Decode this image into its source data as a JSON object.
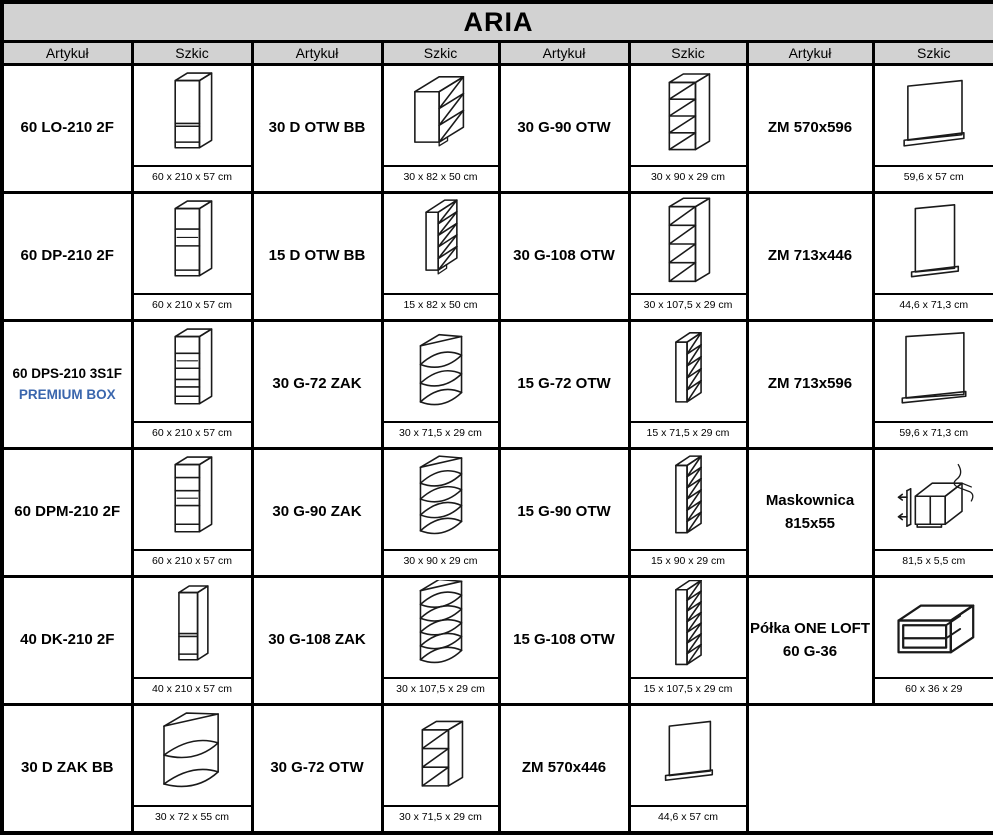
{
  "title": "ARIA",
  "column_headers": [
    "Artykuł",
    "Szkic",
    "Artykuł",
    "Szkic",
    "Artykuł",
    "Szkic",
    "Artykuł",
    "Szkic"
  ],
  "colors": {
    "header_bg": "#d2d2d2",
    "accent_blue": "#3a66ad",
    "line_color": "#1a1a1a"
  },
  "rows": [
    [
      {
        "article": "60 LO-210 2F",
        "sketch": "tall-cabinet-2f",
        "dims": "60 x 210 x 57 cm"
      },
      {
        "article": "30 D OTW BB",
        "sketch": "base-open-shelf",
        "dims": "30 x 82 x 50 cm"
      },
      {
        "article": "30 G-90 OTW",
        "sketch": "wall-open-4",
        "dims": "30 x 90 x 29 cm"
      },
      {
        "article": "ZM 570x596",
        "sketch": "panel",
        "dims": "59,6 x 57 cm"
      }
    ],
    [
      {
        "article": "60 DP-210 2F",
        "sketch": "tall-cabinet-niche",
        "dims": "60 x 210 x 57 cm"
      },
      {
        "article": "15 D OTW BB",
        "sketch": "narrow-base-open",
        "dims": "15 x 82 x 50 cm"
      },
      {
        "article": "30 G-108 OTW",
        "sketch": "wall-open-4-tall",
        "dims": "30 x 107,5 x 29 cm"
      },
      {
        "article": "ZM 713x446",
        "sketch": "panel-tall",
        "dims": "44,6 x 71,3 cm"
      }
    ],
    [
      {
        "article": "60 DPS-210 3S1F",
        "article_line2": "PREMIUM BOX",
        "accent": true,
        "small": true,
        "sketch": "tall-cabinet-drawers",
        "dims": "60 x 210 x 57 cm"
      },
      {
        "article": "30 G-72 ZAK",
        "sketch": "corner-shelf-3",
        "dims": "30 x 71,5 x 29 cm"
      },
      {
        "article": "15 G-72 OTW",
        "sketch": "narrow-wall-open-5",
        "dims": "15 x 71,5 x 29 cm"
      },
      {
        "article": "ZM 713x596",
        "sketch": "panel-wide",
        "dims": "59,6 x 71,3 cm"
      }
    ],
    [
      {
        "article": "60 DPM-210 2F",
        "sketch": "tall-cabinet-niche-2",
        "dims": "60 x 210 x 57 cm"
      },
      {
        "article": "30 G-90 ZAK",
        "sketch": "corner-shelf-4",
        "dims": "30 x 90 x 29 cm"
      },
      {
        "article": "15 G-90 OTW",
        "sketch": "narrow-wall-open-6",
        "dims": "15 x 90 x 29 cm"
      },
      {
        "article": "Maskownica",
        "article_line2": "815x55",
        "sketch": "masking-strip-cabinet",
        "dims": "81,5 x 5,5 cm"
      }
    ],
    [
      {
        "article": "40 DK-210 2F",
        "sketch": "tall-cabinet-2f-narrow",
        "dims": "40 x 210 x 57 cm"
      },
      {
        "article": "30 G-108 ZAK",
        "sketch": "corner-shelf-5",
        "dims": "30 x 107,5 x 29 cm"
      },
      {
        "article": "15 G-108 OTW",
        "sketch": "narrow-wall-open-7",
        "dims": "15 x 107,5 x 29 cm"
      },
      {
        "article": "Półka ONE LOFT",
        "article_line2": "60 G-36",
        "sketch": "open-shelf-box",
        "dims": "60 x 36 x 29"
      }
    ],
    [
      {
        "article": "30 D ZAK BB",
        "sketch": "corner-base-open",
        "dims": "30 x 72 x 55 cm"
      },
      {
        "article": "30 G-72 OTW",
        "sketch": "wall-open-3",
        "dims": "30 x 71,5 x 29 cm"
      },
      {
        "article": "ZM 570x446",
        "sketch": "panel-rail",
        "dims": "44,6 x 57 cm"
      },
      null
    ]
  ]
}
